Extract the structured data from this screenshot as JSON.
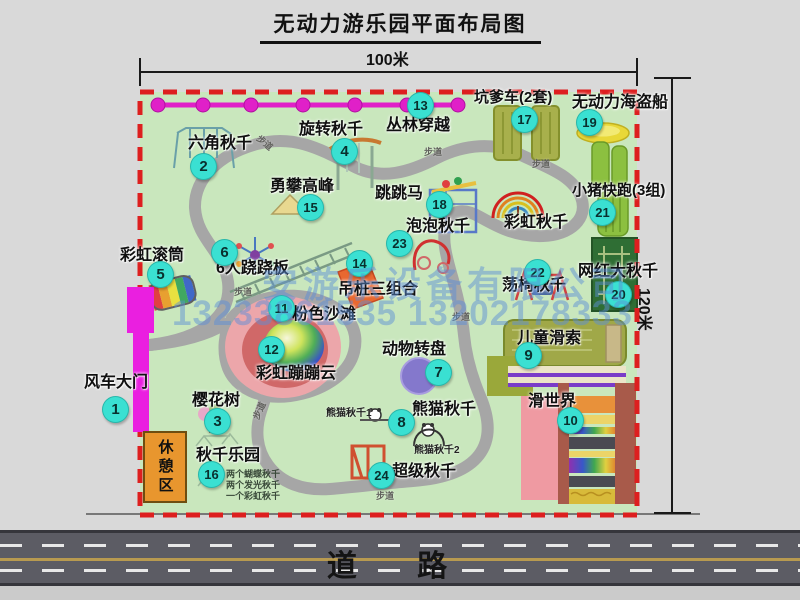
{
  "title": "无动力游乐园平面布局图",
  "dimensions": {
    "width": "100米",
    "height": "120米"
  },
  "road_label": "道 路",
  "rest_area_label": "休憩区",
  "watermark": {
    "company": "安游乐设备有限公司",
    "phones": "13233861535 13202178333"
  },
  "labels": {
    "walkway": "步道",
    "rainbow_swing": "彩虹秋千",
    "panda_swing_1": "熊猫秋千1",
    "panda_swing_2": "熊猫秋千2",
    "swing_park_note_1": "两个蝴蝶秋千",
    "swing_park_note_2": "两个发光秋千",
    "swing_park_note_3": "一个彩虹秋千"
  },
  "attractions": [
    {
      "num": "1",
      "name": "风车大门"
    },
    {
      "num": "2",
      "name": "六角秋千"
    },
    {
      "num": "3",
      "name": "樱花树"
    },
    {
      "num": "4",
      "name": "旋转秋千"
    },
    {
      "num": "5",
      "name": "彩虹滚筒"
    },
    {
      "num": "6",
      "name": "6人跷跷板"
    },
    {
      "num": "7",
      "name": "动物转盘"
    },
    {
      "num": "8",
      "name": "熊猫秋千"
    },
    {
      "num": "9",
      "name": "儿童滑索"
    },
    {
      "num": "10",
      "name": "滑世界"
    },
    {
      "num": "11",
      "name": "粉色沙滩"
    },
    {
      "num": "12",
      "name": "彩虹蹦蹦云"
    },
    {
      "num": "13",
      "name": "丛林穿越"
    },
    {
      "num": "14",
      "name": "吊桩三组合"
    },
    {
      "num": "15",
      "name": "勇攀高峰"
    },
    {
      "num": "16",
      "name": "秋千乐园"
    },
    {
      "num": "17",
      "name": "坑爹车(2套)"
    },
    {
      "num": "18",
      "name": "跳跳马"
    },
    {
      "num": "19",
      "name": "无动力海盗船"
    },
    {
      "num": "20",
      "name": "网红大秋千"
    },
    {
      "num": "21",
      "name": "小猪快跑(3组)"
    },
    {
      "num": "22",
      "name": "荡椅秋千"
    },
    {
      "num": "23",
      "name": "泡泡秋千"
    },
    {
      "num": "24",
      "name": "超级秋千"
    }
  ],
  "colors": {
    "park_green": "#c9e7bd",
    "border_red": "#dd1f1f",
    "badge_cyan": "#3ae0d2",
    "zipline_magenta": "#e020c8",
    "gate_magenta": "#ea1fe0",
    "road_gray": "#5c5c64"
  }
}
